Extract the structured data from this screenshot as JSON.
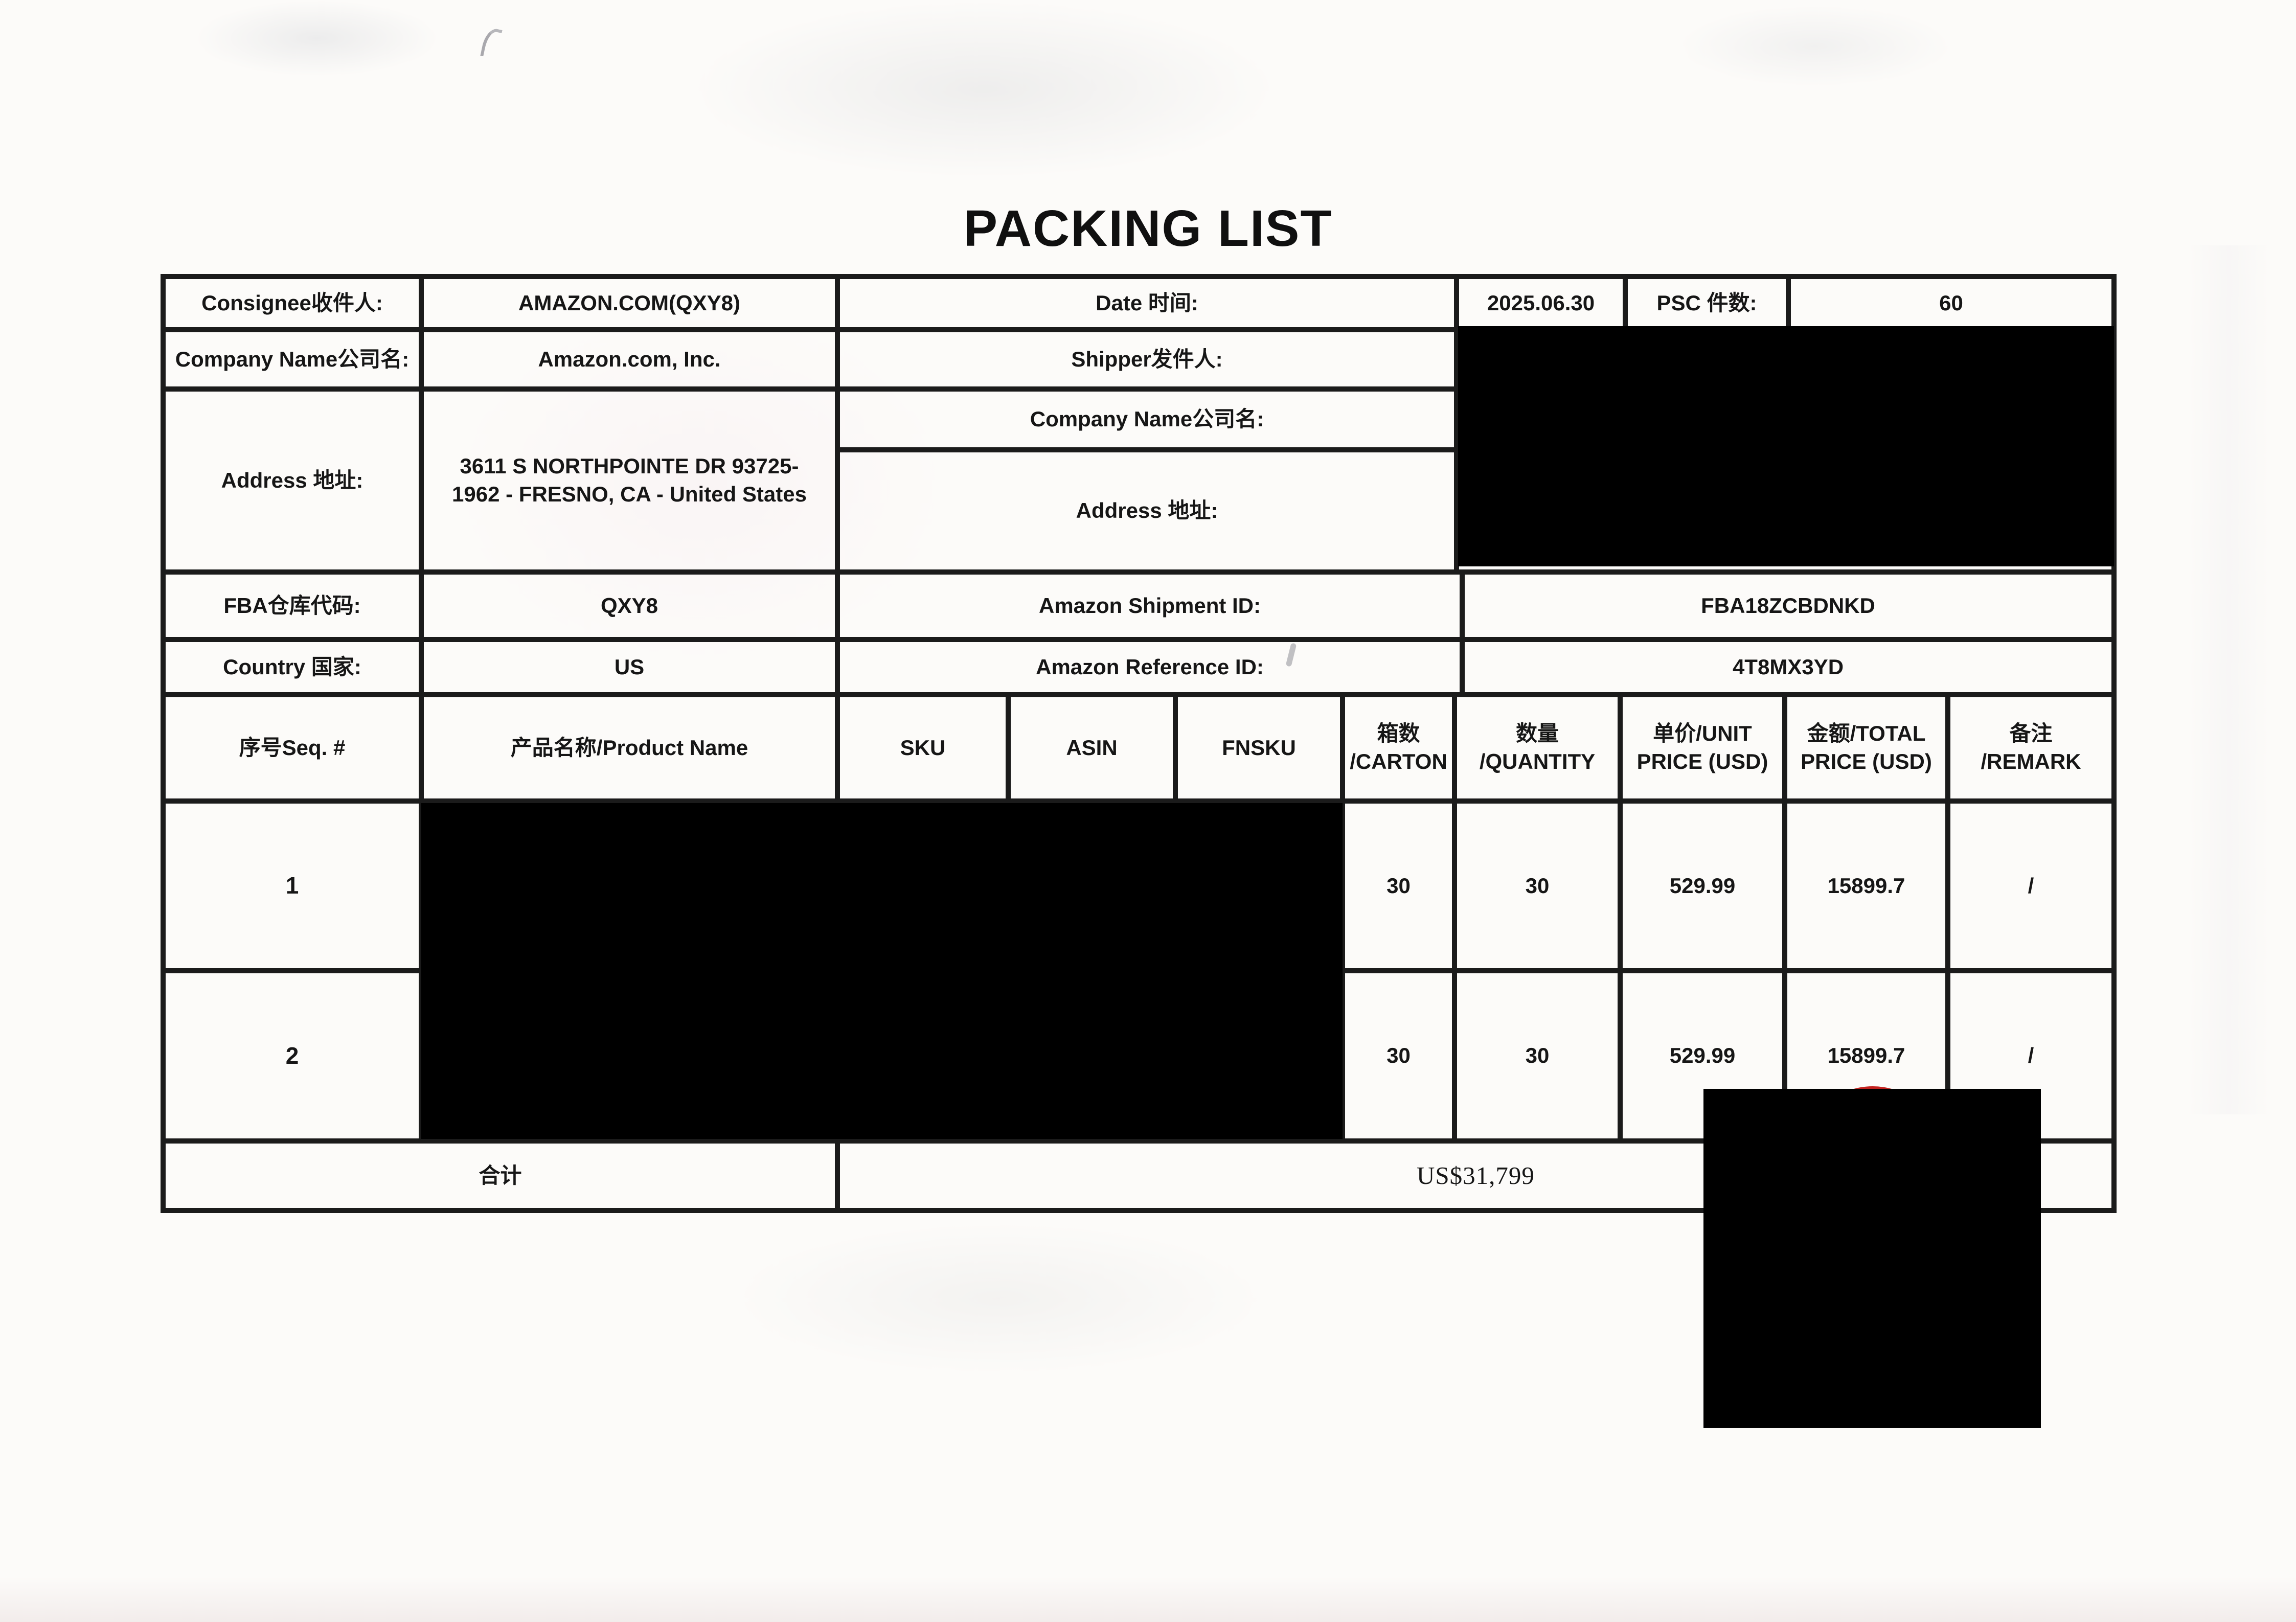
{
  "title": "PACKING LIST",
  "colors": {
    "ink": "#161616",
    "border": "#1b1b1b",
    "stamp_red": "#c2201d",
    "redaction": "#000000",
    "paper": "#fcfbf9"
  },
  "shipment_info": {
    "consignee": {
      "label": "Consignee收件人:",
      "value": "AMAZON.COM(QXY8)"
    },
    "date": {
      "label": "Date 时间:",
      "value": "2025.06.30"
    },
    "psc": {
      "label": "PSC 件数:",
      "value": "60"
    },
    "company": {
      "label": "Company Name公司名:",
      "value": "Amazon.com, Inc."
    },
    "shipper": {
      "label": "Shipper发件人:"
    },
    "consignee_address": {
      "label": "Address 地址:",
      "line1": "3611 S NORTHPOINTE DR 93725-",
      "line2": "1962 - FRESNO, CA - United States"
    },
    "shipper_company": {
      "label": "Company Name公司名:"
    },
    "shipper_address": {
      "label": "Address 地址:"
    },
    "fba_warehouse": {
      "label": "FBA仓库代码:",
      "value": "QXY8"
    },
    "shipment_id": {
      "label": "Amazon Shipment ID:",
      "value": "FBA18ZCBDNKD"
    },
    "country": {
      "label": "Country 国家:",
      "value": "US"
    },
    "reference_id": {
      "label": "Amazon Reference ID:",
      "value": "4T8MX3YD"
    }
  },
  "items_table": {
    "headers": {
      "seq": "序号Seq. #",
      "product_name": "产品名称/Product Name",
      "sku": "SKU",
      "asin": "ASIN",
      "fnsku": "FNSKU",
      "carton": {
        "line1": "箱数",
        "line2": "/CARTON"
      },
      "quantity": {
        "line1": "数量",
        "line2": "/QUANTITY"
      },
      "unit_price": {
        "line1": "单价/UNIT",
        "line2": "PRICE (USD)"
      },
      "total_price": {
        "line1": "金额/TOTAL",
        "line2": "PRICE (USD)"
      },
      "remark": {
        "line1": "备注",
        "line2": "/REMARK"
      }
    },
    "rows": [
      {
        "seq": "1",
        "carton": "30",
        "quantity": "30",
        "unit_price": "529.99",
        "total_price": "15899.7",
        "remark": "/"
      },
      {
        "seq": "2",
        "carton": "30",
        "quantity": "30",
        "unit_price": "529.99",
        "total_price": "15899.7",
        "remark": "/"
      }
    ],
    "total": {
      "label": "合计",
      "value": "US$31,799"
    }
  }
}
